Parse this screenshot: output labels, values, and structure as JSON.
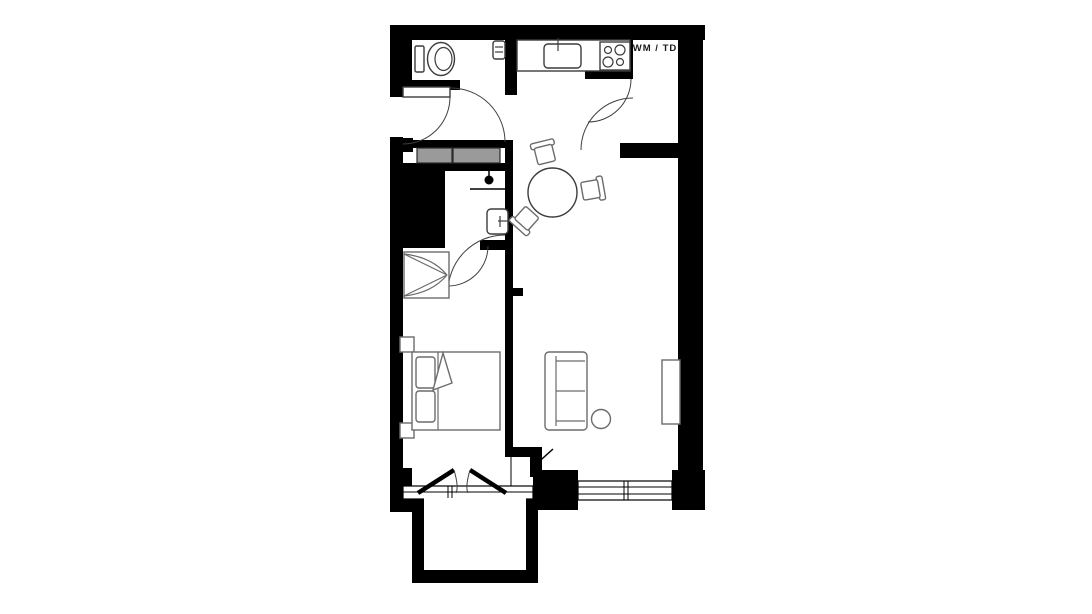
{
  "floor_plan": {
    "utility_label": "WM / TD",
    "colors": {
      "wall": "#000000",
      "background": "#ffffff",
      "closet_fill": "#9a9a9a",
      "fixture_stroke": "#3c3c3c",
      "furniture_stroke": "#6b6b6b"
    }
  }
}
